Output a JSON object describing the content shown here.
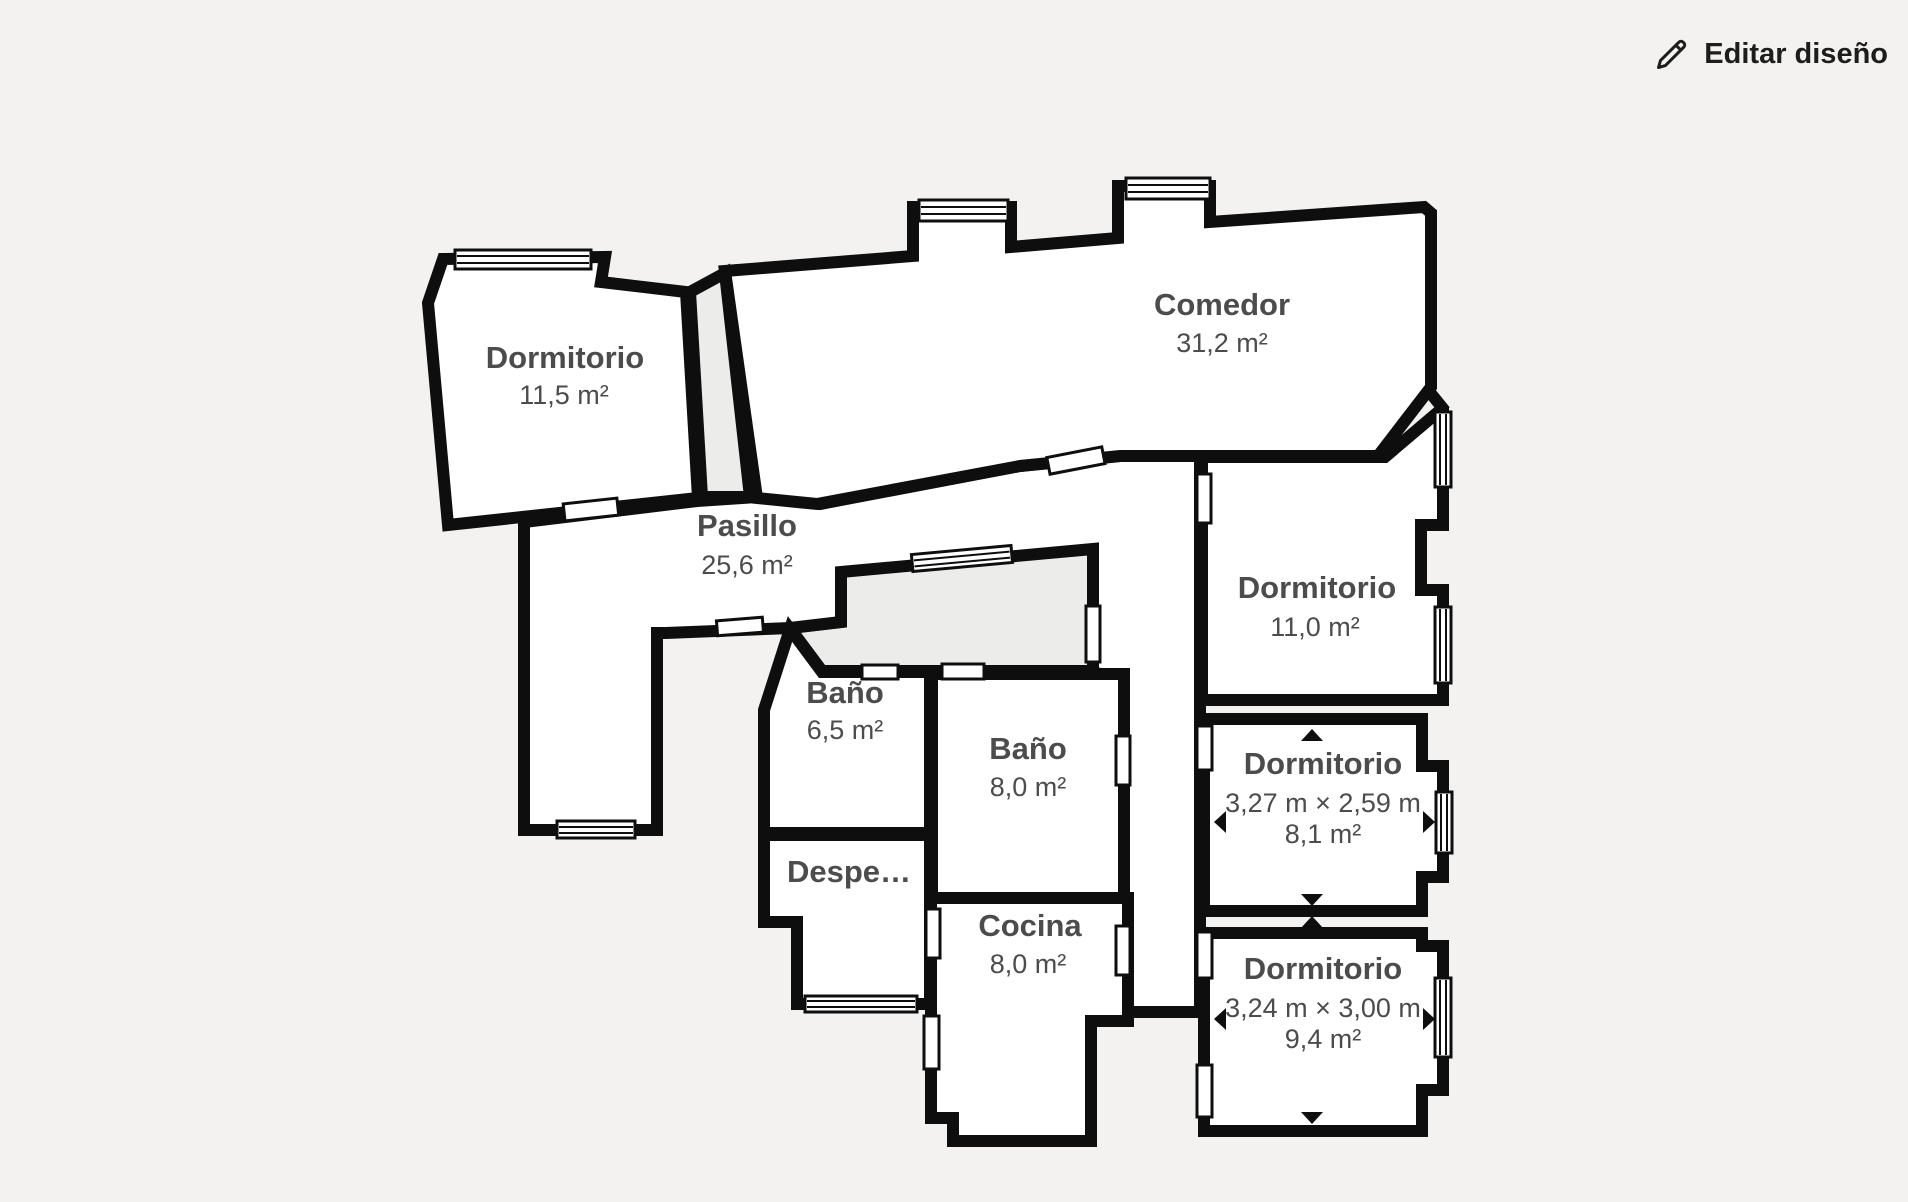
{
  "header": {
    "edit_button": {
      "label": "Editar diseño",
      "icon": "pencil-icon"
    }
  },
  "floorplan": {
    "rooms": {
      "dormitorio_top_left": {
        "name": "Dormitorio",
        "area": "11,5 m²"
      },
      "comedor": {
        "name": "Comedor",
        "area": "31,2 m²"
      },
      "pasillo": {
        "name": "Pasillo",
        "area": "25,6 m²"
      },
      "bano_small": {
        "name": "Baño",
        "area": "6,5 m²"
      },
      "bano_large": {
        "name": "Baño",
        "area": "8,0 m²"
      },
      "despensa": {
        "name": "Despe…"
      },
      "cocina": {
        "name": "Cocina",
        "area": "8,0 m²"
      },
      "dormitorio_right": {
        "name": "Dormitorio",
        "area": "11,0 m²"
      },
      "dormitorio_mid": {
        "name": "Dormitorio",
        "dimensions": "3,27 m × 2,59 m",
        "area": "8,1 m²"
      },
      "dormitorio_bottom": {
        "name": "Dormitorio",
        "dimensions": "3,24 m × 3,00 m",
        "area": "9,4 m²"
      }
    },
    "colors": {
      "background": "#f3f2f0",
      "room": "#ffffff",
      "wall": "#0e0e0e",
      "patio": "#ececea",
      "label": "#4c4c4c",
      "edit_text": "#1d1d1b"
    }
  }
}
